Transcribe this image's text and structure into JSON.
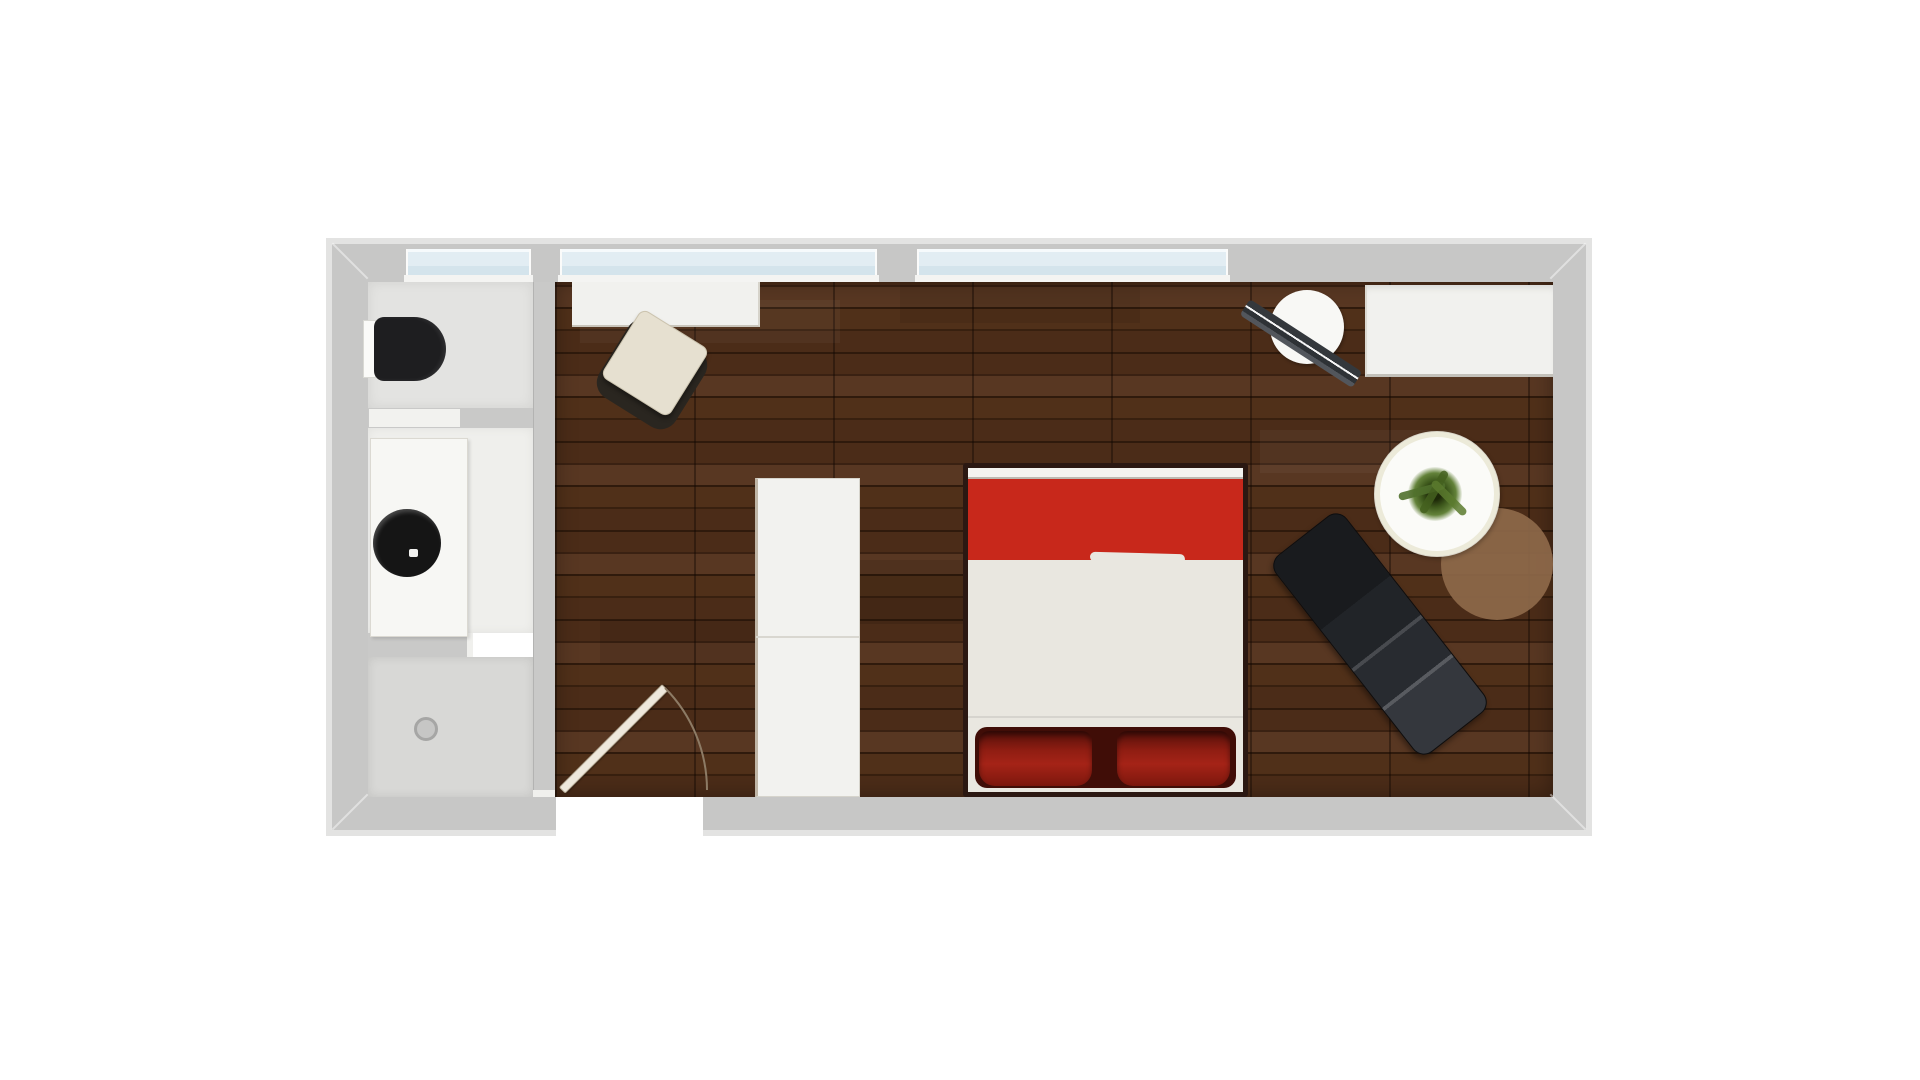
{
  "scene": {
    "name": "apartment-floor-plan",
    "canvas": {
      "width": 1920,
      "height": 1080,
      "background": "#ffffff"
    },
    "palette": {
      "wood_base": "#44281a",
      "wood_a": "#4b2c18",
      "wood_b": "#38200f",
      "wood_c": "#503019",
      "wood_d": "#2f1a0c",
      "wood_e": "#583722",
      "wood_f": "#3a2112",
      "seam": "rgba(15,6,1,0.4)",
      "wall": "#c7c7c6",
      "wall_rim": "#e3e3e2",
      "glass_hi": "#f6fafc",
      "glass": "#e2edf3",
      "glass_lo": "#d4e4ec",
      "bed_red": "#c8281b",
      "pillow_red": "#9e2015",
      "sheet": "#e9e7e0",
      "bed_frame": "#2b1812",
      "chaise_black": "#202328",
      "rug_brown": "#8d6849",
      "chair_beige": "#e6e0d0",
      "furniture_white": "#f2f2ef",
      "bath_floor": "#e3e3e1",
      "vanity_floor": "#efefec",
      "shower_floor": "#d8d8d6",
      "toilet_black": "#1e1e20",
      "sink_black": "#151515",
      "plant_green": "#50702c",
      "door_leaf": "#eee8dc",
      "door_arc": "#8d7b65"
    },
    "elements": [
      {
        "name": "main-room-floor",
        "shape": "rect",
        "x": 555,
        "y": 280,
        "w": 998,
        "h": 517,
        "cls": "wood",
        "interactable": false
      },
      {
        "name": "toilet-room-floor",
        "shape": "rect",
        "x": 368,
        "y": 282,
        "w": 165,
        "h": 126,
        "color": "#e3e3e1",
        "css": "box-shadow:inset 0 0 12px rgba(0,0,0,.08)",
        "interactable": false
      },
      {
        "name": "vanity-room-floor",
        "shape": "rect",
        "x": 368,
        "y": 428,
        "w": 165,
        "h": 205,
        "color": "#efefec",
        "css": "box-shadow:inset 0 0 10px rgba(0,0,0,.06)",
        "interactable": false
      },
      {
        "name": "shower-floor",
        "shape": "rect",
        "x": 368,
        "y": 657,
        "w": 165,
        "h": 140,
        "color": "#d8d8d6",
        "css": "box-shadow:inset 0 0 10px rgba(0,0,0,.10)",
        "interactable": false
      },
      {
        "name": "shower-drain",
        "shape": "circle",
        "cx": 426,
        "cy": 729,
        "r": 12,
        "color": "#c6c6c5",
        "css": "border:3px solid #a6a6a5",
        "interactable": false
      },
      {
        "name": "floor-shade-1",
        "shape": "rect",
        "x": 580,
        "y": 300,
        "w": 260,
        "h": 43,
        "color": "rgba(255,255,255,0.035)",
        "interactable": false
      },
      {
        "name": "floor-shade-2",
        "shape": "rect",
        "x": 860,
        "y": 560,
        "w": 300,
        "h": 64,
        "color": "rgba(0,0,0,0.10)",
        "interactable": false
      },
      {
        "name": "floor-shade-3",
        "shape": "rect",
        "x": 600,
        "y": 620,
        "w": 200,
        "h": 43,
        "color": "rgba(0,0,0,0.08)",
        "interactable": false
      },
      {
        "name": "floor-shade-4",
        "shape": "rect",
        "x": 1260,
        "y": 430,
        "w": 200,
        "h": 43,
        "color": "rgba(255,255,255,0.04)",
        "interactable": false
      },
      {
        "name": "floor-shade-5",
        "shape": "rect",
        "x": 900,
        "y": 281,
        "w": 240,
        "h": 42,
        "color": "rgba(0,0,0,0.07)",
        "interactable": false
      },
      {
        "name": "round-rug",
        "shape": "circle",
        "cx": 1497,
        "cy": 564,
        "r": 56,
        "color": "#8d6849",
        "css": "opacity:.93",
        "interactable": false
      },
      {
        "name": "desk",
        "shape": "rect",
        "x": 572,
        "y": 282,
        "w": 188,
        "h": 45,
        "color": "#f1f1ee",
        "css": "border-bottom:2px solid #c9c5bb;border-right:2px solid #d6d3ca",
        "interactable": false
      },
      {
        "name": "desk-chair-base",
        "shape": "rect",
        "x": 607,
        "y": 329,
        "w": 90,
        "h": 90,
        "rot": 32,
        "radius": "18px",
        "color": "#2a2620",
        "interactable": false
      },
      {
        "name": "desk-chair-seat",
        "shape": "rect",
        "x": 615,
        "y": 323,
        "w": 80,
        "h": 80,
        "rot": 32,
        "radius": "8px",
        "color": "#e6e0d0",
        "css": "border:1px solid #cbc3ae;box-shadow:2px 3px 4px rgba(0,0,0,.35)",
        "interactable": false
      },
      {
        "name": "tall-cabinet",
        "shape": "rect",
        "x": 755,
        "y": 478,
        "w": 105,
        "h": 319,
        "color": "#f2f2ef",
        "css": "border:1px solid #d6d4cc;border-left:3px solid #bfb5a6",
        "interactable": false
      },
      {
        "name": "tall-cabinet-seam",
        "shape": "rect",
        "x": 756,
        "y": 636,
        "w": 103,
        "h": 2,
        "color": "#d9d7d0",
        "interactable": false
      },
      {
        "name": "bed-frame",
        "shape": "rect",
        "x": 963,
        "y": 463,
        "w": 285,
        "h": 334,
        "color": "#e9e7e0",
        "css": "border:5px solid #2b1812;border-radius:3px",
        "interactable": false
      },
      {
        "name": "bed-footboard",
        "shape": "rect",
        "x": 968,
        "y": 468,
        "w": 275,
        "h": 11,
        "color": "#f4f3ef",
        "css": "border-bottom:2px solid #bdb9b0",
        "interactable": false
      },
      {
        "name": "bed-blanket",
        "shape": "rect",
        "x": 968,
        "y": 479,
        "w": 275,
        "h": 81,
        "color": "#c8281b",
        "interactable": false
      },
      {
        "name": "bed-blanket-fold",
        "shape": "rect",
        "x": 1090,
        "y": 553,
        "w": 95,
        "h": 10,
        "rot": 1.5,
        "radius": "5px",
        "color": "#e9e7e0",
        "interactable": false
      },
      {
        "name": "bed-sheet-crease",
        "shape": "rect",
        "x": 968,
        "y": 716,
        "w": 275,
        "h": 2,
        "color": "rgba(0,0,0,0.08)",
        "interactable": false
      },
      {
        "name": "pillow-shadow",
        "shape": "rect",
        "x": 975,
        "y": 727,
        "w": 261,
        "h": 61,
        "radius": "12px",
        "color": "#400d07",
        "interactable": false
      },
      {
        "name": "pillow-left",
        "shape": "rect",
        "x": 979,
        "y": 731,
        "w": 113,
        "h": 55,
        "css": "background:linear-gradient(180deg,#53100a 0%,#8f1d12 35%,#a52317 60%,#7c170d 100%);border-radius:10px 10px 16px 16px;box-shadow:inset 0 4px 6px rgba(0,0,0,.45)",
        "interactable": false
      },
      {
        "name": "pillow-right",
        "shape": "rect",
        "x": 1117,
        "y": 731,
        "w": 113,
        "h": 55,
        "css": "background:linear-gradient(180deg,#53100a 0%,#8f1d12 35%,#a52317 60%,#7c170d 100%);border-radius:10px 10px 16px 16px;box-shadow:inset 0 4px 6px rgba(0,0,0,.45)",
        "interactable": false
      },
      {
        "name": "wall-wardrobe",
        "shape": "rect",
        "x": 1365,
        "y": 285,
        "w": 188,
        "h": 92,
        "color": "#f1f1ee",
        "css": "border-left:2px solid #dbd9d2;border-bottom:3px solid #c3c1ba;box-shadow:inset 0 6px 8px -4px rgba(0,0,0,.12)",
        "interactable": false
      },
      {
        "name": "hat-seat",
        "shape": "circle",
        "cx": 1307,
        "cy": 327,
        "r": 37,
        "color": "#f8f8f5",
        "css": "box-shadow:1px 2px 3px rgba(0,0,0,.3)",
        "interactable": false
      },
      {
        "name": "hat-band",
        "shape": "rect",
        "x": 1234,
        "y": 334,
        "w": 134,
        "h": 19,
        "rot": 33,
        "radius": "4px",
        "css": "background:linear-gradient(180deg,#34383c 0 7px,#f5f5f5 7px 9px,#2e3236 9px 14px,#52565c 14px 19px)",
        "interactable": false
      },
      {
        "name": "round-table",
        "shape": "circle",
        "cx": 1437,
        "cy": 494,
        "r": 63,
        "color": "#fbfbf8",
        "css": "border:1px solid #d9d5c8;box-shadow:inset 0 0 0 5px #ecead9,1px 2px 4px rgba(0,0,0,.25)",
        "interactable": false
      },
      {
        "name": "plant",
        "shape": "circle",
        "cx": 1435,
        "cy": 494,
        "r": 27,
        "css": "background:radial-gradient(circle,#1d2808 0 15%,#3f5a1d 35%,#63823a 55%,rgba(99,130,58,0) 72%)",
        "interactable": false
      },
      {
        "name": "plant-leaf-1",
        "shape": "rect",
        "x": 1398,
        "y": 487,
        "w": 48,
        "h": 8,
        "rot": -15,
        "radius": "4px",
        "color": "#50702c",
        "css": "opacity:.9",
        "interactable": false
      },
      {
        "name": "plant-leaf-2",
        "shape": "rect",
        "x": 1430,
        "y": 468,
        "w": 8,
        "h": 48,
        "rot": 30,
        "radius": "4px",
        "color": "#44601f",
        "css": "opacity:.85",
        "interactable": false
      },
      {
        "name": "plant-leaf-3",
        "shape": "rect",
        "x": 1426,
        "y": 494,
        "w": 46,
        "h": 8,
        "rot": 45,
        "radius": "4px",
        "color": "#5a7a2e",
        "css": "opacity:.85",
        "interactable": false
      },
      {
        "name": "chaise-longue",
        "shape": "rect",
        "x": 1255,
        "y": 589,
        "w": 250,
        "h": 90,
        "rot": 52,
        "radius": "14px",
        "css": "background:linear-gradient(90deg,rgba(255,255,255,0) 0 54%,rgba(255,255,255,.15) 54% 55.5%,rgba(255,255,255,0) 55.5% 74%,rgba(255,255,255,.18) 74% 75.5%,rgba(255,255,255,0) 75.5%),linear-gradient(90deg,#191b1e 0 34%,#212428 34% 54%,#282b30 54% 74%,#34373d 74% 100%);border:1px solid #0c0d0f;box-shadow:2px 3px 6px rgba(0,0,0,.4)",
        "interactable": false
      },
      {
        "name": "entry-door-leaf",
        "shape": "rect",
        "x": 562,
        "y": 786,
        "w": 146,
        "h": 9,
        "rot": -45,
        "origin": "0% 50%",
        "color": "#eee8dc",
        "css": "border:1px solid #b9ae99;border-radius:2px;box-shadow:1px 1px 2px rgba(0,0,0,.35)",
        "interactable": false
      },
      {
        "name": "entry-door-swing-arc",
        "shape": "path",
        "d": "M 665 688 A 145 145 0 0 1 707 790",
        "stroke": "#8d7b65",
        "sw": 2,
        "fill": "none",
        "interactable": false
      },
      {
        "name": "wall-outer-rim",
        "shape": "rect",
        "x": 326,
        "y": 238,
        "w": 1266,
        "h": 598,
        "css": "border:6px solid #e3e3e2;background:transparent",
        "interactable": false
      },
      {
        "name": "wall-frame",
        "shape": "rect",
        "x": 332,
        "y": 244,
        "w": 1254,
        "h": 586,
        "css": "border-style:solid;border-color:#c7c7c6;border-width:38px 33px 33px 36px;background:transparent",
        "interactable": false
      },
      {
        "name": "wall-miter-top-left",
        "shape": "rect",
        "x": 325,
        "y": 260,
        "w": 50,
        "h": 2,
        "rot": 45,
        "color": "rgba(255,255,255,0.45)",
        "interactable": false
      },
      {
        "name": "wall-miter-top-right",
        "shape": "rect",
        "x": 1543,
        "y": 260,
        "w": 50,
        "h": 2,
        "rot": -45,
        "color": "rgba(255,255,255,0.45)",
        "interactable": false
      },
      {
        "name": "wall-miter-bottom-left",
        "shape": "rect",
        "x": 325,
        "y": 811,
        "w": 50,
        "h": 2,
        "rot": -45,
        "color": "rgba(255,255,255,0.45)",
        "interactable": false
      },
      {
        "name": "wall-miter-bottom-right",
        "shape": "rect",
        "x": 1543,
        "y": 811,
        "w": 50,
        "h": 2,
        "rot": 45,
        "color": "rgba(255,255,255,0.45)",
        "interactable": false
      },
      {
        "name": "bathroom-partition-wall",
        "shape": "rect",
        "x": 533,
        "y": 282,
        "w": 22,
        "h": 515,
        "color": "#c9c9c8",
        "css": "border-left:1px solid #b3b3b2",
        "interactable": false
      },
      {
        "name": "bathroom-partition-cap",
        "shape": "rect",
        "x": 533,
        "y": 790,
        "w": 22,
        "h": 7,
        "color": "#f0f0ed",
        "interactable": false
      },
      {
        "name": "toilet-room-wall",
        "shape": "rect",
        "x": 368,
        "y": 408,
        "w": 165,
        "h": 20,
        "color": "#c9c9c8",
        "interactable": false
      },
      {
        "name": "toilet-room-door",
        "shape": "rect",
        "x": 369,
        "y": 409,
        "w": 91,
        "h": 18,
        "color": "#f2f2ef",
        "interactable": false
      },
      {
        "name": "shower-wall",
        "shape": "rect",
        "x": 368,
        "y": 633,
        "w": 105,
        "h": 24,
        "color": "#c9c9c8",
        "interactable": false
      },
      {
        "name": "shower-wall-cap",
        "shape": "rect",
        "x": 467,
        "y": 633,
        "w": 6,
        "h": 24,
        "color": "#f0f0ed",
        "interactable": false
      },
      {
        "name": "toilet-tank",
        "shape": "rect",
        "x": 363,
        "y": 320,
        "w": 13,
        "h": 58,
        "color": "#fafaf8",
        "css": "border:1px solid #d8d8d3",
        "interactable": false
      },
      {
        "name": "toilet-seat",
        "shape": "rect",
        "x": 374,
        "y": 317,
        "w": 72,
        "h": 64,
        "radius": "10px 32px 32px 10px",
        "color": "#1e1e20",
        "css": "box-shadow:inset -3px 0 4px rgba(255,255,255,.08)",
        "interactable": false
      },
      {
        "name": "vanity-counter",
        "shape": "rect",
        "x": 370,
        "y": 438,
        "w": 98,
        "h": 199,
        "color": "#f7f7f4",
        "css": "border:1px solid #dbd9d2;box-shadow:2px 2px 3px rgba(0,0,0,.12)",
        "interactable": false
      },
      {
        "name": "sink-bowl",
        "shape": "circle",
        "cx": 407,
        "cy": 543,
        "r": 34,
        "color": "#151515",
        "css": "box-shadow:inset 2px 3px 4px rgba(255,255,255,.22)",
        "interactable": false
      },
      {
        "name": "sink-soap",
        "shape": "rect",
        "x": 409,
        "y": 549,
        "w": 9,
        "h": 8,
        "radius": "2px",
        "color": "#f2f2f0",
        "interactable": false
      },
      {
        "name": "window-bathroom",
        "shape": "rect",
        "x": 406,
        "y": 249,
        "w": 125,
        "h": 26,
        "cls": "glass",
        "interactable": false
      },
      {
        "name": "window-main-left",
        "shape": "rect",
        "x": 560,
        "y": 249,
        "w": 317,
        "h": 26,
        "cls": "glass",
        "interactable": false
      },
      {
        "name": "window-main-right",
        "shape": "rect",
        "x": 917,
        "y": 249,
        "w": 311,
        "h": 26,
        "cls": "glass",
        "interactable": false
      },
      {
        "name": "window-sill-bathroom",
        "shape": "rect",
        "x": 404,
        "y": 275,
        "w": 129,
        "h": 7,
        "color": "#f4f4f2",
        "interactable": false
      },
      {
        "name": "window-sill-main-left",
        "shape": "rect",
        "x": 558,
        "y": 275,
        "w": 321,
        "h": 7,
        "color": "#f4f4f2",
        "interactable": false
      },
      {
        "name": "window-sill-main-right",
        "shape": "rect",
        "x": 915,
        "y": 275,
        "w": 315,
        "h": 7,
        "color": "#f4f4f2",
        "interactable": false
      },
      {
        "name": "entry-door-opening",
        "shape": "rect",
        "x": 556,
        "y": 797,
        "w": 147,
        "h": 39,
        "color": "#ffffff",
        "interactable": false
      }
    ]
  }
}
